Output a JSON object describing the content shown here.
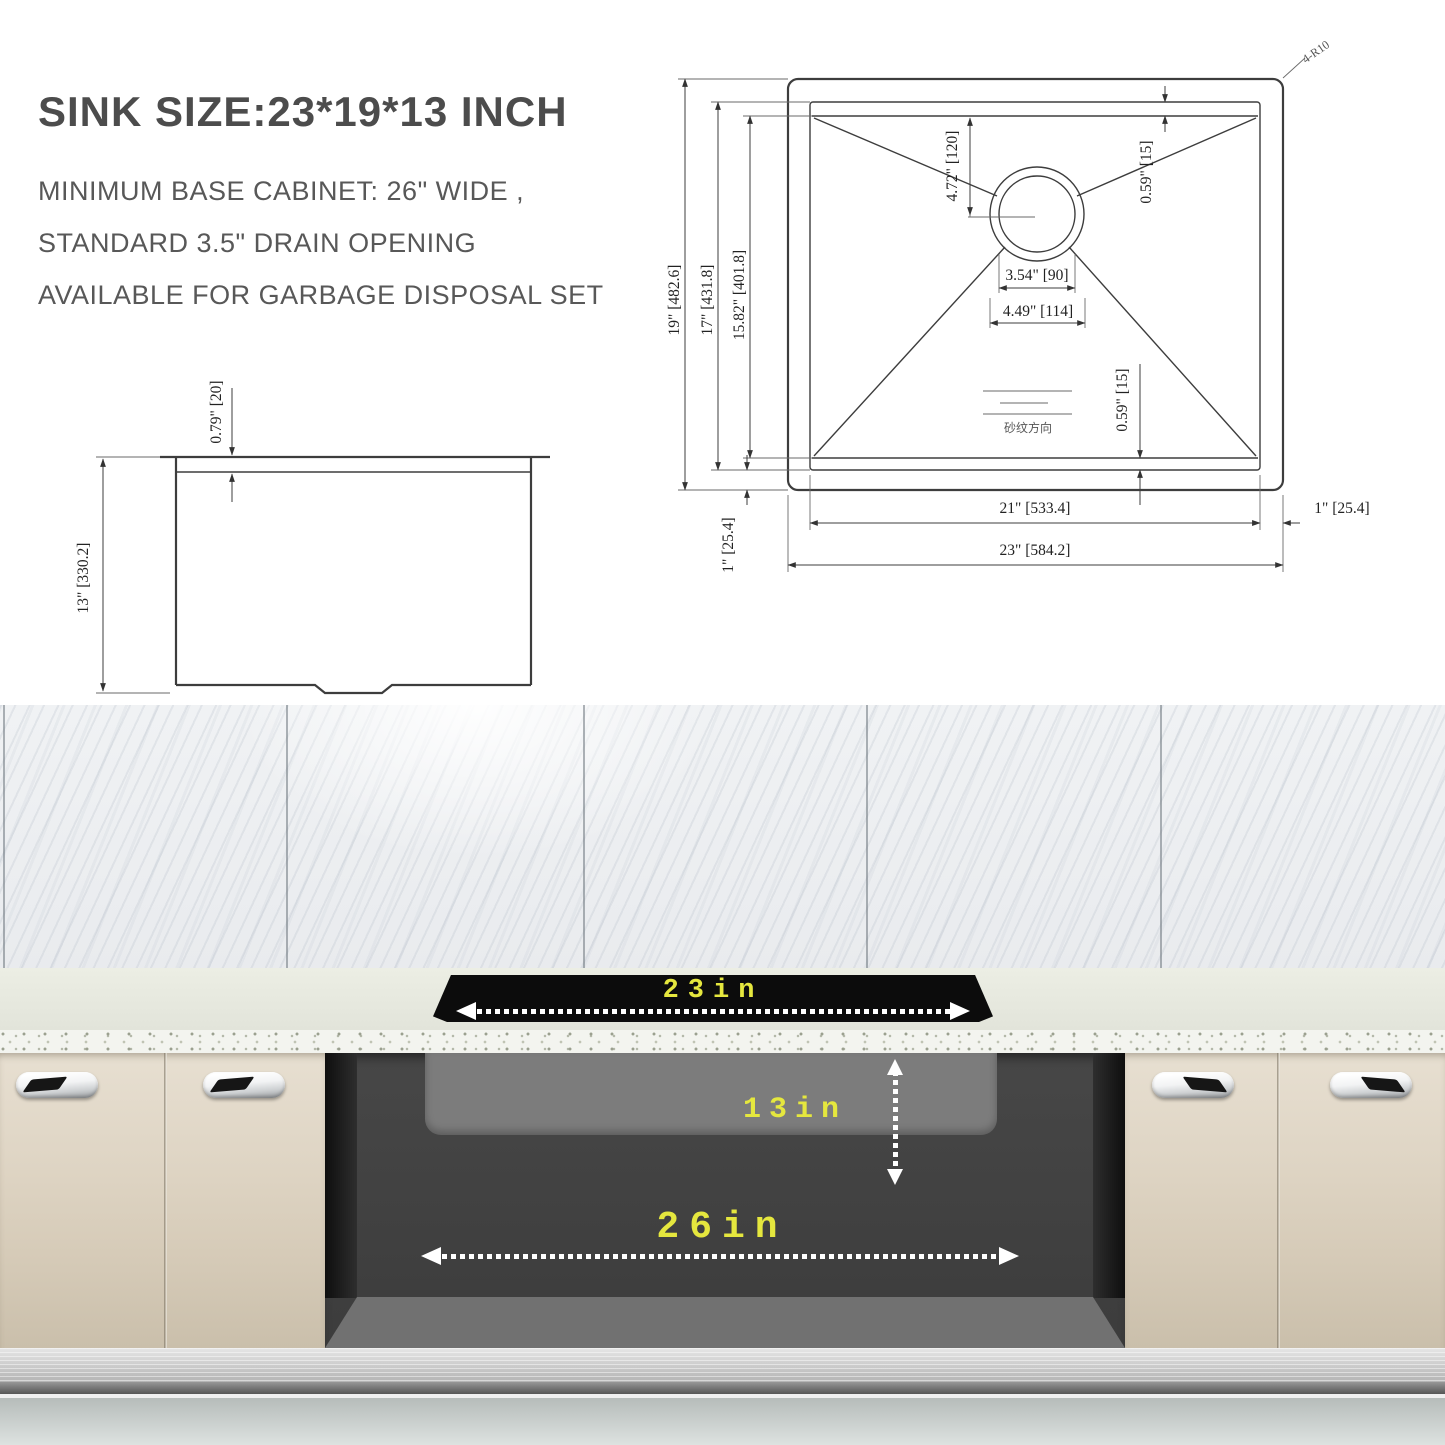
{
  "specs": {
    "title": "SINK SIZE:23*19*13 INCH",
    "line1": "MINIMUM BASE CABINET: 26\" WIDE ,",
    "line2": "STANDARD 3.5\" DRAIN OPENING",
    "line3": "AVAILABLE FOR GARBAGE DISPOSAL SET"
  },
  "plan_view": {
    "overall_length": "19\" [482.6]",
    "inner_length": "17\" [431.8]",
    "bowl_length": "15.82\" [401.8]",
    "drain_offset": "4.72\" [120]",
    "rim_top": "0.59\" [15]",
    "drain_inner_dia": "3.54\" [90]",
    "drain_outer_dia": "4.49\" [114]",
    "rim_bottom": "0.59\" [15]",
    "grain_note": "砂纹方向",
    "inner_width": "21\" [533.4]",
    "right_margin": "1\" [25.4]",
    "overall_width": "23\" [584.2]",
    "left_margin": "1\" [25.4]",
    "corner_note": "4-R10"
  },
  "side_view": {
    "rim_height": "0.79\" [20]",
    "depth": "13\" [330.2]"
  },
  "photo": {
    "cutout_width": "23in",
    "sink_depth": "13in",
    "cabinet_width": "26in",
    "accent_yellow": "#e5e73e",
    "cabinet_beige": "#ded4c3",
    "interior_gray": "#3f3f3f"
  }
}
